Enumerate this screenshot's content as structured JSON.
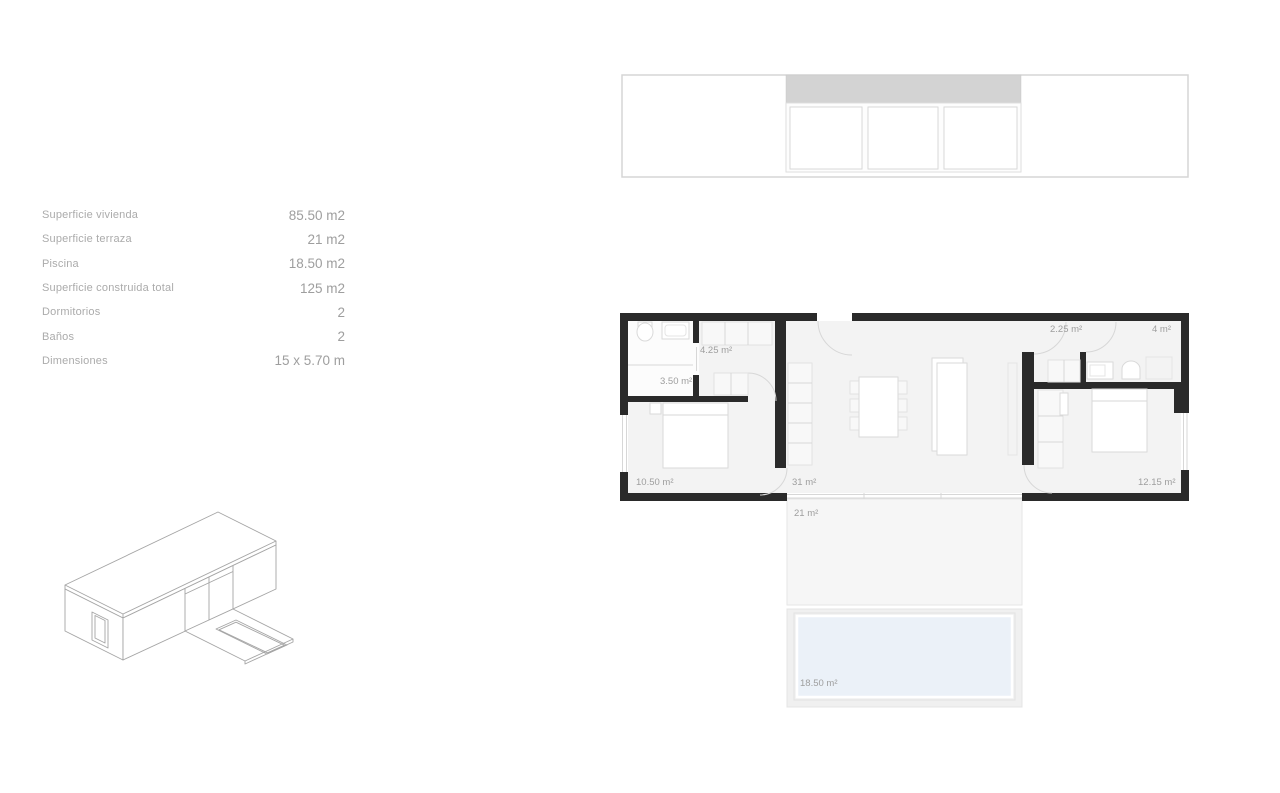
{
  "specs": {
    "rows": [
      {
        "label": "Superficie vivienda",
        "value": "85.50 m2"
      },
      {
        "label": "Superficie terraza",
        "value": "21 m2"
      },
      {
        "label": "Piscina",
        "value": "18.50 m2"
      },
      {
        "label": "Superficie construida total",
        "value": "125 m2"
      },
      {
        "label": "Dormitorios",
        "value": "2"
      },
      {
        "label": "Baños",
        "value": "2"
      },
      {
        "label": "Dimensiones",
        "value": "15 x 5.70 m"
      }
    ]
  },
  "floor_plan": {
    "labels": {
      "bath_small": "4.25 m²",
      "utility": "3.50 m²",
      "bedroom_left": "10.50 m²",
      "living": "31 m²",
      "hall": "2.25 m²",
      "bath_right": "4 m²",
      "bedroom_right": "12.15 m²",
      "terrace": "21 m²",
      "pool": "18.50 m²"
    }
  },
  "colors": {
    "wall": "#2a2a2a",
    "floor": "#f3f3f3",
    "floor_white": "#fcfcfc",
    "pool_water": "#ebf1f8",
    "elev_band": "#d3d3d3",
    "muted": "#ababab",
    "muted2": "#9e9e9e",
    "line": "#d7d7d7",
    "furn_stroke": "#dadada"
  }
}
